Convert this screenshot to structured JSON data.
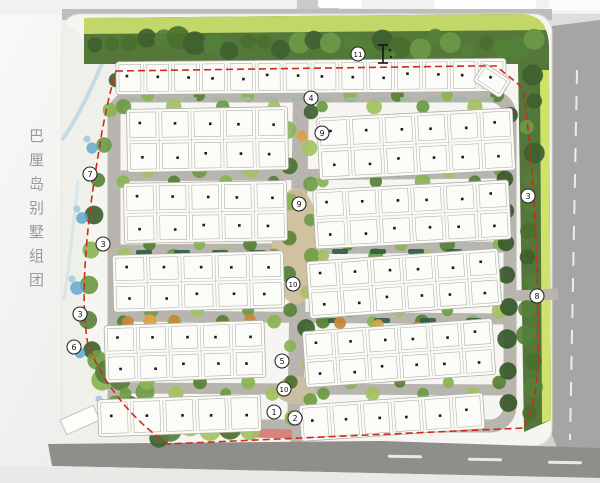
{
  "plan": {
    "title": "巴厘岛别墅组团",
    "markers": [
      {
        "label": "11",
        "x": 358,
        "y": 54
      },
      {
        "label": "4",
        "x": 311,
        "y": 98
      },
      {
        "label": "9",
        "x": 322,
        "y": 133
      },
      {
        "label": "7",
        "x": 90,
        "y": 174
      },
      {
        "label": "9",
        "x": 299,
        "y": 204
      },
      {
        "label": "3",
        "x": 528,
        "y": 196
      },
      {
        "label": "3",
        "x": 103,
        "y": 244
      },
      {
        "label": "10",
        "x": 293,
        "y": 284
      },
      {
        "label": "8",
        "x": 537,
        "y": 296
      },
      {
        "label": "3",
        "x": 80,
        "y": 314
      },
      {
        "label": "6",
        "x": 74,
        "y": 347
      },
      {
        "label": "5",
        "x": 282,
        "y": 361
      },
      {
        "label": "10",
        "x": 284,
        "y": 389
      },
      {
        "label": "1",
        "x": 274,
        "y": 412
      },
      {
        "label": "2",
        "x": 295,
        "y": 418
      }
    ],
    "scale_marker": {
      "x": 383,
      "y": 54
    },
    "colors": {
      "boundary_red": "#cf2b1d",
      "water_blue": "#62a9ce",
      "water_blue_light": "#9dc6dc",
      "canopy_dark": "#3f6130",
      "canopy_light": "#8ab454",
      "lawn_light_green": "#cde16d",
      "road_gray": "#b8b5af",
      "outer_road_gray": "#a6a5a3",
      "bottom_road_gray": "#8f8e8b",
      "plaza_tan": "#d0c1a0",
      "accent_orange": "#c8893b",
      "villa_white": "#fbfbf8",
      "marker_stroke": "#2b2b2b"
    },
    "villa_blocks": [
      {
        "id": "north-row",
        "x": 116,
        "y": 60,
        "w": 390,
        "h": 33,
        "rows": 1,
        "cols": 14,
        "angle": -0.5
      },
      {
        "id": "north-row-end",
        "x": 476,
        "y": 70,
        "w": 32,
        "h": 21,
        "rows": 1,
        "cols": 1,
        "angle": 33
      },
      {
        "id": "west-1",
        "x": 127,
        "y": 108,
        "w": 161,
        "h": 63,
        "rows": 2,
        "cols": 5,
        "angle": -1
      },
      {
        "id": "west-2",
        "x": 124,
        "y": 182,
        "w": 163,
        "h": 60,
        "rows": 2,
        "cols": 5,
        "angle": -1
      },
      {
        "id": "west-3",
        "x": 113,
        "y": 253,
        "w": 171,
        "h": 57,
        "rows": 2,
        "cols": 5,
        "angle": -1.5
      },
      {
        "id": "west-4",
        "x": 105,
        "y": 323,
        "w": 160,
        "h": 57,
        "rows": 2,
        "cols": 5,
        "angle": -2
      },
      {
        "id": "west-5",
        "x": 98,
        "y": 397,
        "w": 163,
        "h": 37,
        "rows": 1,
        "cols": 5,
        "angle": -2
      },
      {
        "id": "east-1",
        "x": 318,
        "y": 113,
        "w": 196,
        "h": 62,
        "rows": 2,
        "cols": 6,
        "angle": -3
      },
      {
        "id": "east-2",
        "x": 314,
        "y": 185,
        "w": 196,
        "h": 59,
        "rows": 2,
        "cols": 6,
        "angle": -3
      },
      {
        "id": "east-3",
        "x": 308,
        "y": 255,
        "w": 192,
        "h": 57,
        "rows": 2,
        "cols": 6,
        "angle": -4
      },
      {
        "id": "east-4",
        "x": 304,
        "y": 325,
        "w": 190,
        "h": 56,
        "rows": 2,
        "cols": 6,
        "angle": -4
      },
      {
        "id": "east-5",
        "x": 300,
        "y": 399,
        "w": 184,
        "h": 36,
        "rows": 1,
        "cols": 6,
        "angle": -4
      }
    ]
  }
}
